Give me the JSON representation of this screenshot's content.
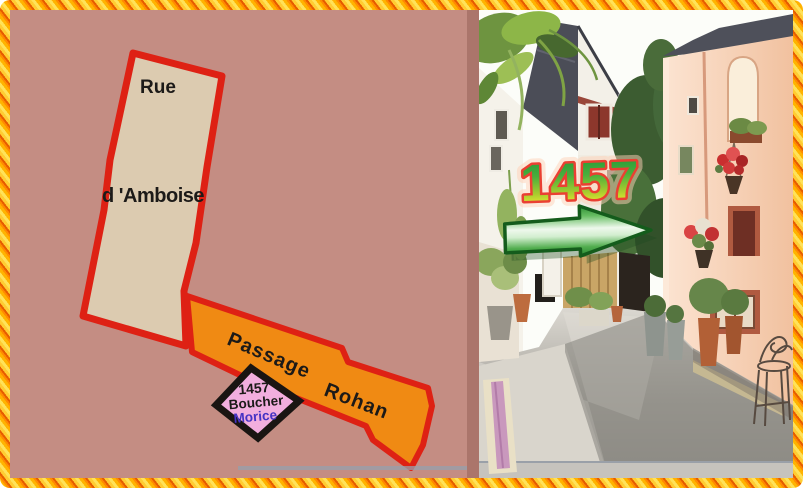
{
  "frame": {
    "style": "diagonal-striped-gold",
    "colors": [
      "#ffe259",
      "#ffb300",
      "#ff8a00",
      "#e65c00"
    ]
  },
  "map": {
    "background_color": "#c48d83",
    "street": {
      "word1": "Rue",
      "word2": "d 'Amboise",
      "fill": "#dccbb0",
      "outline": "#de2114"
    },
    "passage": {
      "word1": "Passage",
      "word2": "Rohan",
      "fill": "#f08a13",
      "outline": "#de2114"
    },
    "parcel": {
      "number": "1457",
      "name_line1": "Boucher",
      "name_line2": "Morice",
      "fill": "#f2aede",
      "outline": "#1a1512",
      "name_line2_color": "#4633c4"
    }
  },
  "photo": {
    "house_number": "1457",
    "house_number_style": {
      "fill_top": "#1f9638",
      "fill_bottom": "#f2f215",
      "outline": "#ea4032"
    },
    "arrow": {
      "direction": "right",
      "fill": "#4fae4b",
      "outline": "#145c1c"
    }
  }
}
